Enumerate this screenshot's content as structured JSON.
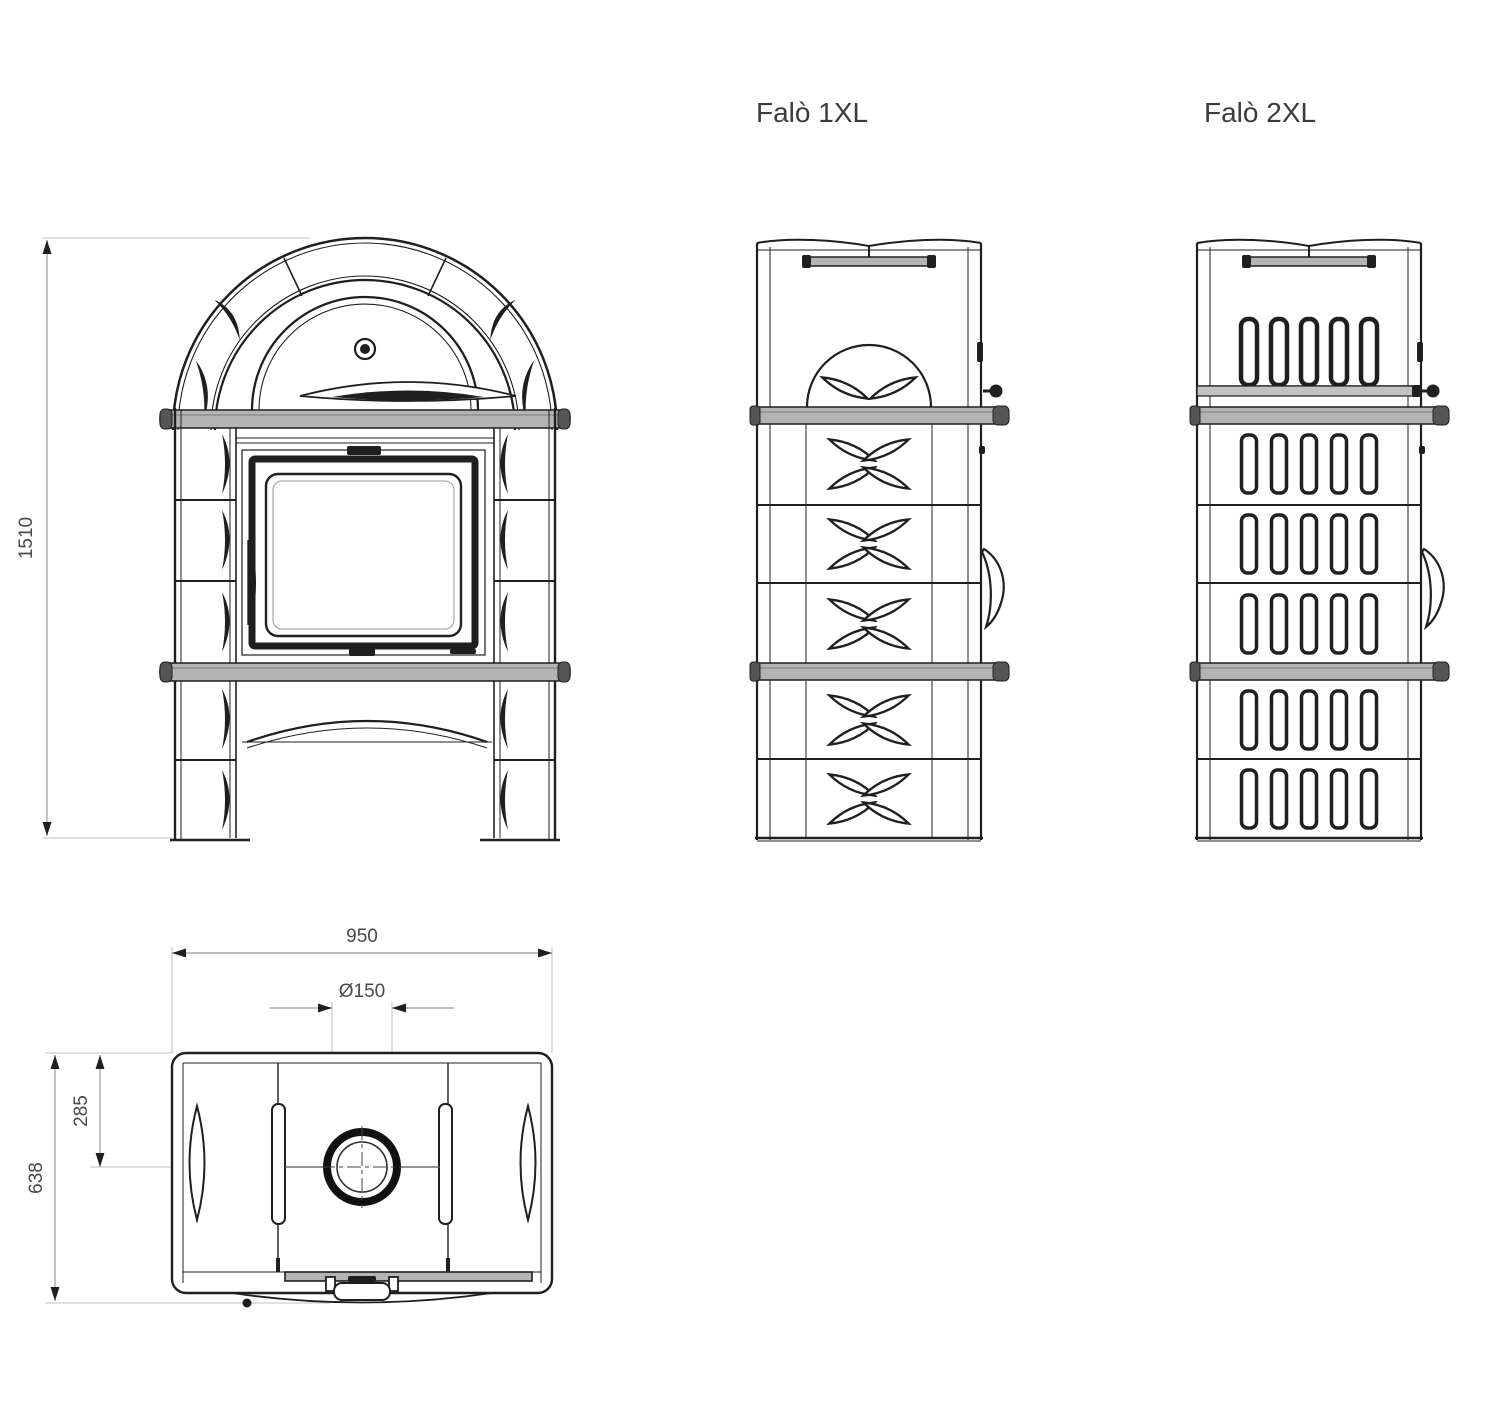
{
  "labels": {
    "model_left": "Falò 1XL",
    "model_right": "Falò 2XL"
  },
  "dimensions": {
    "front_height": "1510",
    "top_width": "950",
    "flue_diameter": "Ø150",
    "flue_offset_depth": "285",
    "total_depth": "638"
  },
  "colors": {
    "background": "#ffffff",
    "line": "#1f1f1f",
    "shelf_fill": "#b4b4b4",
    "dimension_line": "#9b9b9b",
    "dimension_text": "#4a4a4a",
    "label_text": "#3c3c3c"
  }
}
